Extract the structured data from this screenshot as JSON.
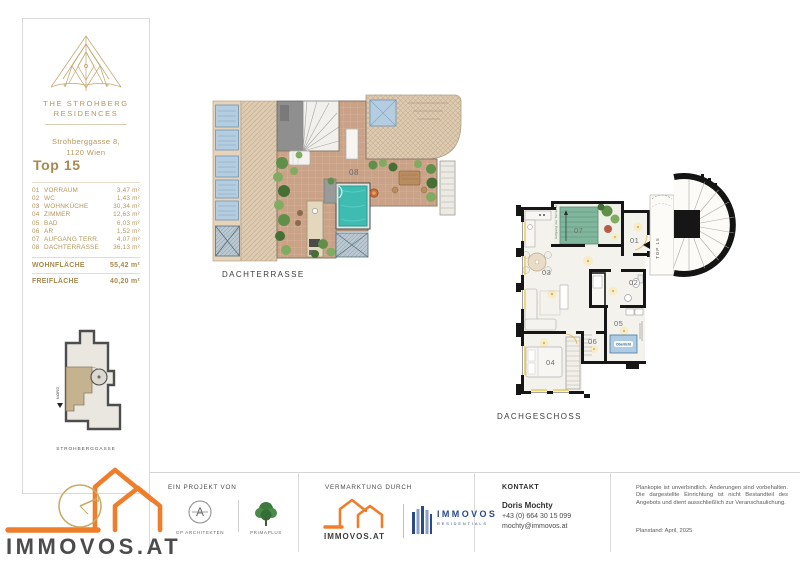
{
  "sidebar": {
    "brand_line1": "THE STROHBERG",
    "brand_line2": "RESIDENCES",
    "address_line1": "Strohberggasse 8,",
    "address_line2": "1120 Wien",
    "unit_title": "Top 15",
    "rooms": [
      {
        "num": "01",
        "name": "VORRAUM",
        "area": "3,47 m²"
      },
      {
        "num": "02",
        "name": "WC",
        "area": "1,43 m²"
      },
      {
        "num": "03",
        "name": "WOHNKÜCHE",
        "area": "30,34 m²"
      },
      {
        "num": "04",
        "name": "ZIMMER",
        "area": "12,63 m²"
      },
      {
        "num": "05",
        "name": "BAD",
        "area": "6,03 m²"
      },
      {
        "num": "06",
        "name": "AR",
        "area": "1,52 m²"
      },
      {
        "num": "07",
        "name": "AUFGANG TERR.",
        "area": "4,07 m²"
      },
      {
        "num": "08",
        "name": "DACHTERRASSE",
        "area": "36,13 m²"
      }
    ],
    "total_living_label": "WOHNFLÄCHE",
    "total_living_value": "55,42 m²",
    "total_outdoor_label": "FREIFLÄCHE",
    "total_outdoor_value": "40,20 m²",
    "siteplan": {
      "north_label": "NORD",
      "street_label": "STROHBERGGASSE"
    }
  },
  "plans": {
    "terrace": {
      "label": "DACHTERRASSE",
      "room_number": "08"
    },
    "floor": {
      "label": "DACHGESCHOSS",
      "entrance_label": "TOP 15",
      "skylight_label": "Oberlicht",
      "stair_note": "Aufgang zur Terrasse",
      "room_labels": {
        "r01": "01",
        "r02": "02",
        "r03": "03",
        "r04": "04",
        "r05": "05",
        "r06": "06",
        "r07": "07"
      }
    }
  },
  "footer": {
    "project_heading": "EIN PROJEKT VON",
    "architect_label": "GP ARCHITEKTEN",
    "partner_label": "PRIMAPLUS",
    "marketing_heading": "VERMARKTUNG DURCH",
    "immovos_small_label": "IMMOVOS.AT",
    "residentials_line1": "IMMOVOS",
    "residentials_line2": "RESIDENTIALS",
    "contact_heading": "KONTAKT",
    "contact_name": "Doris Mochty",
    "contact_phone": "+43 (0) 664 30 15 099",
    "contact_email": "mochty@immovos.at",
    "disclaimer": "Plankopie ist unverbindlich. Änderungen sind vorbehalten. Die dargestellte Einrichtung ist nicht Bestandteil des Angebots und dient ausschließlich zur Veranschaulichung.",
    "plan_date": "Planstand: April, 2025"
  },
  "logo": {
    "main_text": "IMMOVOS.AT"
  }
}
